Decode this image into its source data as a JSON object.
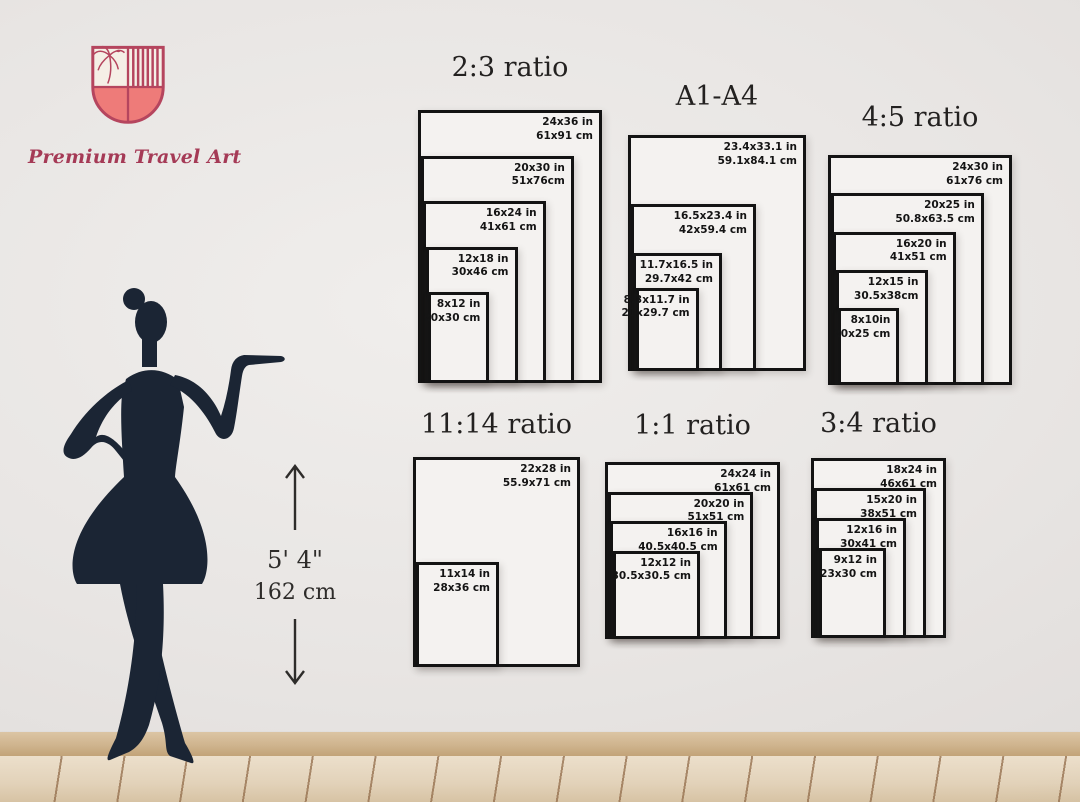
{
  "brand": {
    "name": "Premium Travel Art"
  },
  "height_indicator": {
    "imperial": "5' 4\"",
    "metric": "162 cm"
  },
  "charts": [
    {
      "title": "2:3 ratio",
      "sizes": [
        {
          "inches": "24x36 in",
          "cm": "61x91 cm",
          "w": 24,
          "h": 36
        },
        {
          "inches": "20x30 in",
          "cm": "51x76cm",
          "w": 20,
          "h": 30
        },
        {
          "inches": "16x24 in",
          "cm": "41x61 cm",
          "w": 16,
          "h": 24
        },
        {
          "inches": "12x18 in",
          "cm": "30x46 cm",
          "w": 12,
          "h": 18
        },
        {
          "inches": "8x12 in",
          "cm": "20x30 cm",
          "w": 8,
          "h": 12
        }
      ]
    },
    {
      "title": "A1-A4",
      "sizes": [
        {
          "inches": "23.4x33.1 in",
          "cm": "59.1x84.1 cm",
          "w": 23.4,
          "h": 33.1
        },
        {
          "inches": "16.5x23.4 in",
          "cm": "42x59.4 cm",
          "w": 16.5,
          "h": 23.4
        },
        {
          "inches": "11.7x16.5 in",
          "cm": "29.7x42 cm",
          "w": 11.7,
          "h": 16.5
        },
        {
          "inches": "8.3x11.7 in",
          "cm": "21x29.7 cm",
          "w": 8.3,
          "h": 11.7
        }
      ]
    },
    {
      "title": "4:5 ratio",
      "sizes": [
        {
          "inches": "24x30 in",
          "cm": "61x76 cm",
          "w": 24,
          "h": 30
        },
        {
          "inches": "20x25 in",
          "cm": "50.8x63.5 cm",
          "w": 20,
          "h": 25
        },
        {
          "inches": "16x20 in",
          "cm": "41x51 cm",
          "w": 16,
          "h": 20
        },
        {
          "inches": "12x15 in",
          "cm": "30.5x38cm",
          "w": 12,
          "h": 15
        },
        {
          "inches": "8x10in",
          "cm": "20x25 cm",
          "w": 8,
          "h": 10
        }
      ]
    },
    {
      "title": "11:14 ratio",
      "sizes": [
        {
          "inches": "22x28 in",
          "cm": "55.9x71 cm",
          "w": 22,
          "h": 28
        },
        {
          "inches": "11x14 in",
          "cm": "28x36 cm",
          "w": 11,
          "h": 14
        }
      ]
    },
    {
      "title": "1:1 ratio",
      "sizes": [
        {
          "inches": "24x24 in",
          "cm": "61x61 cm",
          "w": 24,
          "h": 24
        },
        {
          "inches": "20x20 in",
          "cm": "51x51 cm",
          "w": 20,
          "h": 20
        },
        {
          "inches": "16x16 in",
          "cm": "40.5x40.5 cm",
          "w": 16,
          "h": 16
        },
        {
          "inches": "12x12 in",
          "cm": "30.5x30.5 cm",
          "w": 12,
          "h": 12
        }
      ]
    },
    {
      "title": "3:4 ratio",
      "sizes": [
        {
          "inches": "18x24 in",
          "cm": "46x61 cm",
          "w": 18,
          "h": 24
        },
        {
          "inches": "15x20 in",
          "cm": "38x51 cm",
          "w": 15,
          "h": 20
        },
        {
          "inches": "12x16 in",
          "cm": "30x41 cm",
          "w": 12,
          "h": 16
        },
        {
          "inches": "9x12 in",
          "cm": "23x30 cm",
          "w": 9,
          "h": 12
        }
      ]
    }
  ],
  "colors": {
    "frame_black": "#131313",
    "rect_fill": "#f4f2f0",
    "wall": "#e8e5e3",
    "silhouette_navy": "#1b2534",
    "brand_maroon": "#a53a56",
    "shield_outline": "#b5455e",
    "shield_coral": "#ee7b79",
    "shield_cream": "#f5efe6",
    "baseboard_tan": "#cfb48e",
    "floor_wood": "#e2d2b9"
  }
}
